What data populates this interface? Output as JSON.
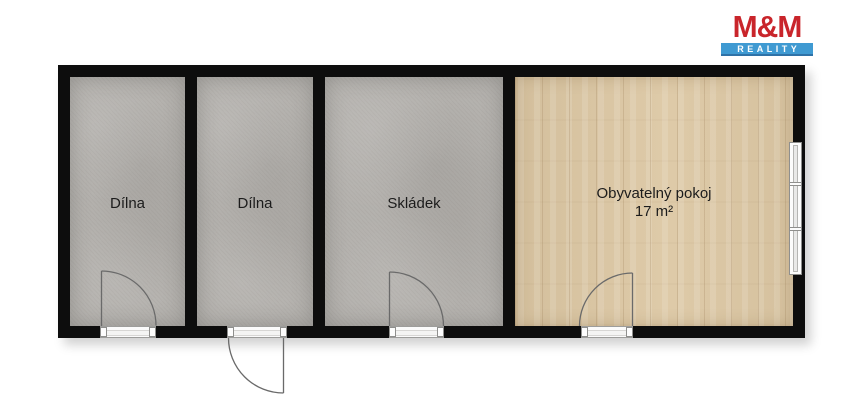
{
  "logo": {
    "title": "M&M",
    "subtitle": "REALITY"
  },
  "rooms": [
    {
      "label": "Dílna",
      "floor": "concrete"
    },
    {
      "label": "Dílna",
      "floor": "concrete"
    },
    {
      "label": "Skládek",
      "floor": "concrete"
    },
    {
      "label": "Obyvatelný pokoj",
      "area": "17 m²",
      "floor": "wood"
    }
  ],
  "plan": {
    "doors": [
      {
        "room": "Dílna",
        "wall": "bottom",
        "swing": "inward, hinge left"
      },
      {
        "room": "Dílna",
        "wall": "bottom",
        "swing": "outward, hinge right"
      },
      {
        "room": "Skládek",
        "wall": "bottom",
        "swing": "inward, hinge left"
      },
      {
        "room": "Obyvatelný pokoj",
        "wall": "bottom",
        "swing": "inward, hinge right"
      }
    ],
    "windows": [
      {
        "room": "Obyvatelný pokoj",
        "wall": "right",
        "panes": 3
      }
    ]
  },
  "colors": {
    "logo-red": "#c9252b",
    "logo-blue": "#3f9ad2",
    "wall": "#0d0d0d",
    "concrete-floor": "#b3b0ac",
    "wood-floor": "#dcc7a3",
    "label-text": "#1c1c1c"
  }
}
